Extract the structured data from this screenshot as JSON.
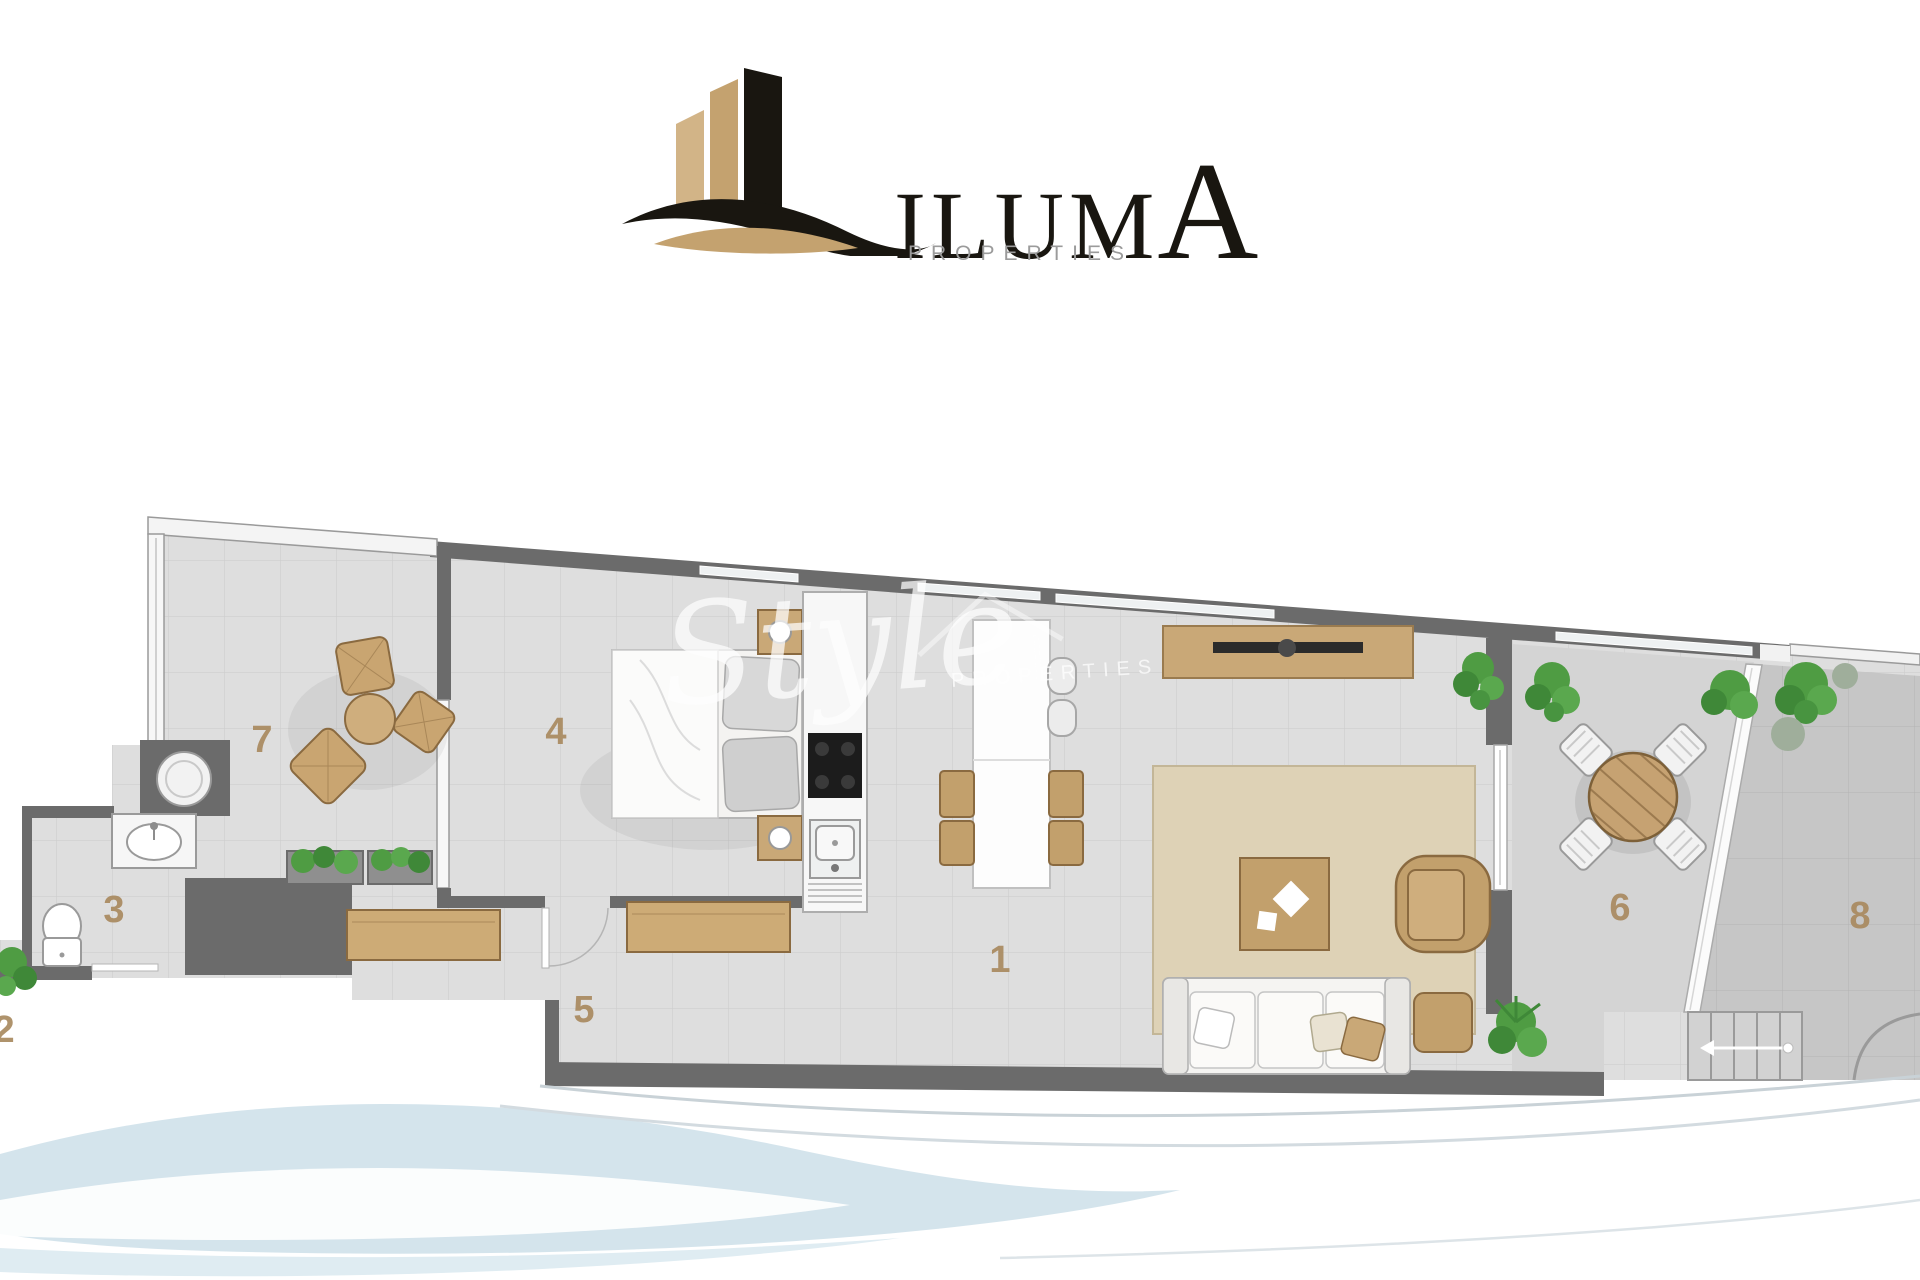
{
  "logo": {
    "brand_main": "ILUM",
    "brand_accent": "A",
    "subtitle": "PROPERTIES"
  },
  "watermark": {
    "script": "Style",
    "subtitle": "PROPERTIES"
  },
  "floorplan": {
    "room_labels": [
      {
        "area": "living-dining-kitchen",
        "number": "1"
      },
      {
        "area": "entry-patio",
        "number": "2"
      },
      {
        "area": "bathroom",
        "number": "3"
      },
      {
        "area": "bedroom",
        "number": "4"
      },
      {
        "area": "hallway",
        "number": "5"
      },
      {
        "area": "dining-terrace",
        "number": "6"
      },
      {
        "area": "lounge-terrace",
        "number": "7"
      },
      {
        "area": "solarium-terrace",
        "number": "8"
      }
    ],
    "palette": {
      "wall": "#6b6b6b",
      "indoor_floor": "#e0e0e0",
      "terrace_floor": "#d6d6d6",
      "solarium_floor": "#c6c6c6",
      "wood_accent": "#c2a06c",
      "rug": "#ded2b6",
      "plant_green": "#4f9c43",
      "room_label_text": "#a98a60",
      "logo_gold": "#c4a26f",
      "logo_black": "#191610",
      "wave_blue": "#cfe1ea"
    }
  }
}
